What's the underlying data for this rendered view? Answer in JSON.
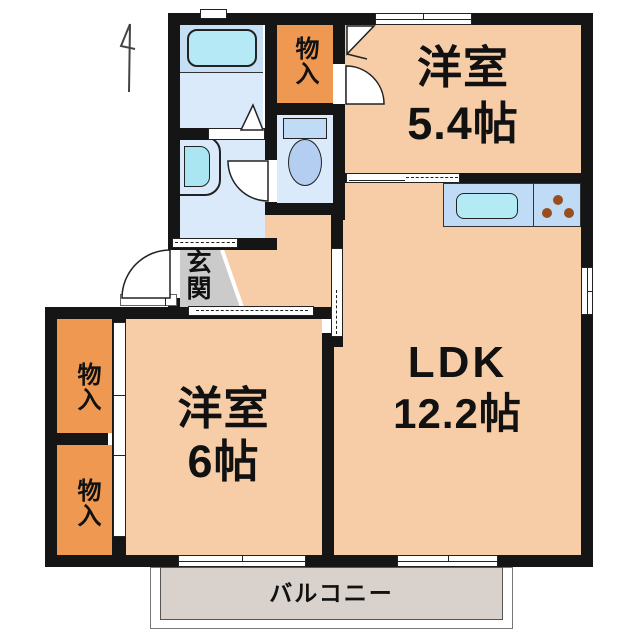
{
  "labels": {
    "room_small": {
      "name": "洋室",
      "area": "5.4帖"
    },
    "ldk": {
      "name": "LDK",
      "area": "12.2帖"
    },
    "room_large": {
      "name": "洋室",
      "area": "6帖"
    },
    "entrance": {
      "name": "玄関"
    },
    "balcony": {
      "name": "バルコニー"
    },
    "closet_upper_right": {
      "name": "物入"
    },
    "closet_left_upper": {
      "name": "物入"
    },
    "closet_left_lower": {
      "name": "物入"
    }
  },
  "colors": {
    "room_floor": "#F6CDA7",
    "closet_floor": "#EE9851",
    "wet_area_floor": "#DAEAFB",
    "bath_floor": "#C7DFF5",
    "bathtub": "#B5E9F6",
    "kitchen_counter": "#BFDBF5",
    "kitchen_sink": "#B4EAF4",
    "stove_burner": "#9A4E20",
    "balcony_floor": "#D9D2CC",
    "entrance_floor": "#CBCBCB",
    "wall": "#151515"
  }
}
